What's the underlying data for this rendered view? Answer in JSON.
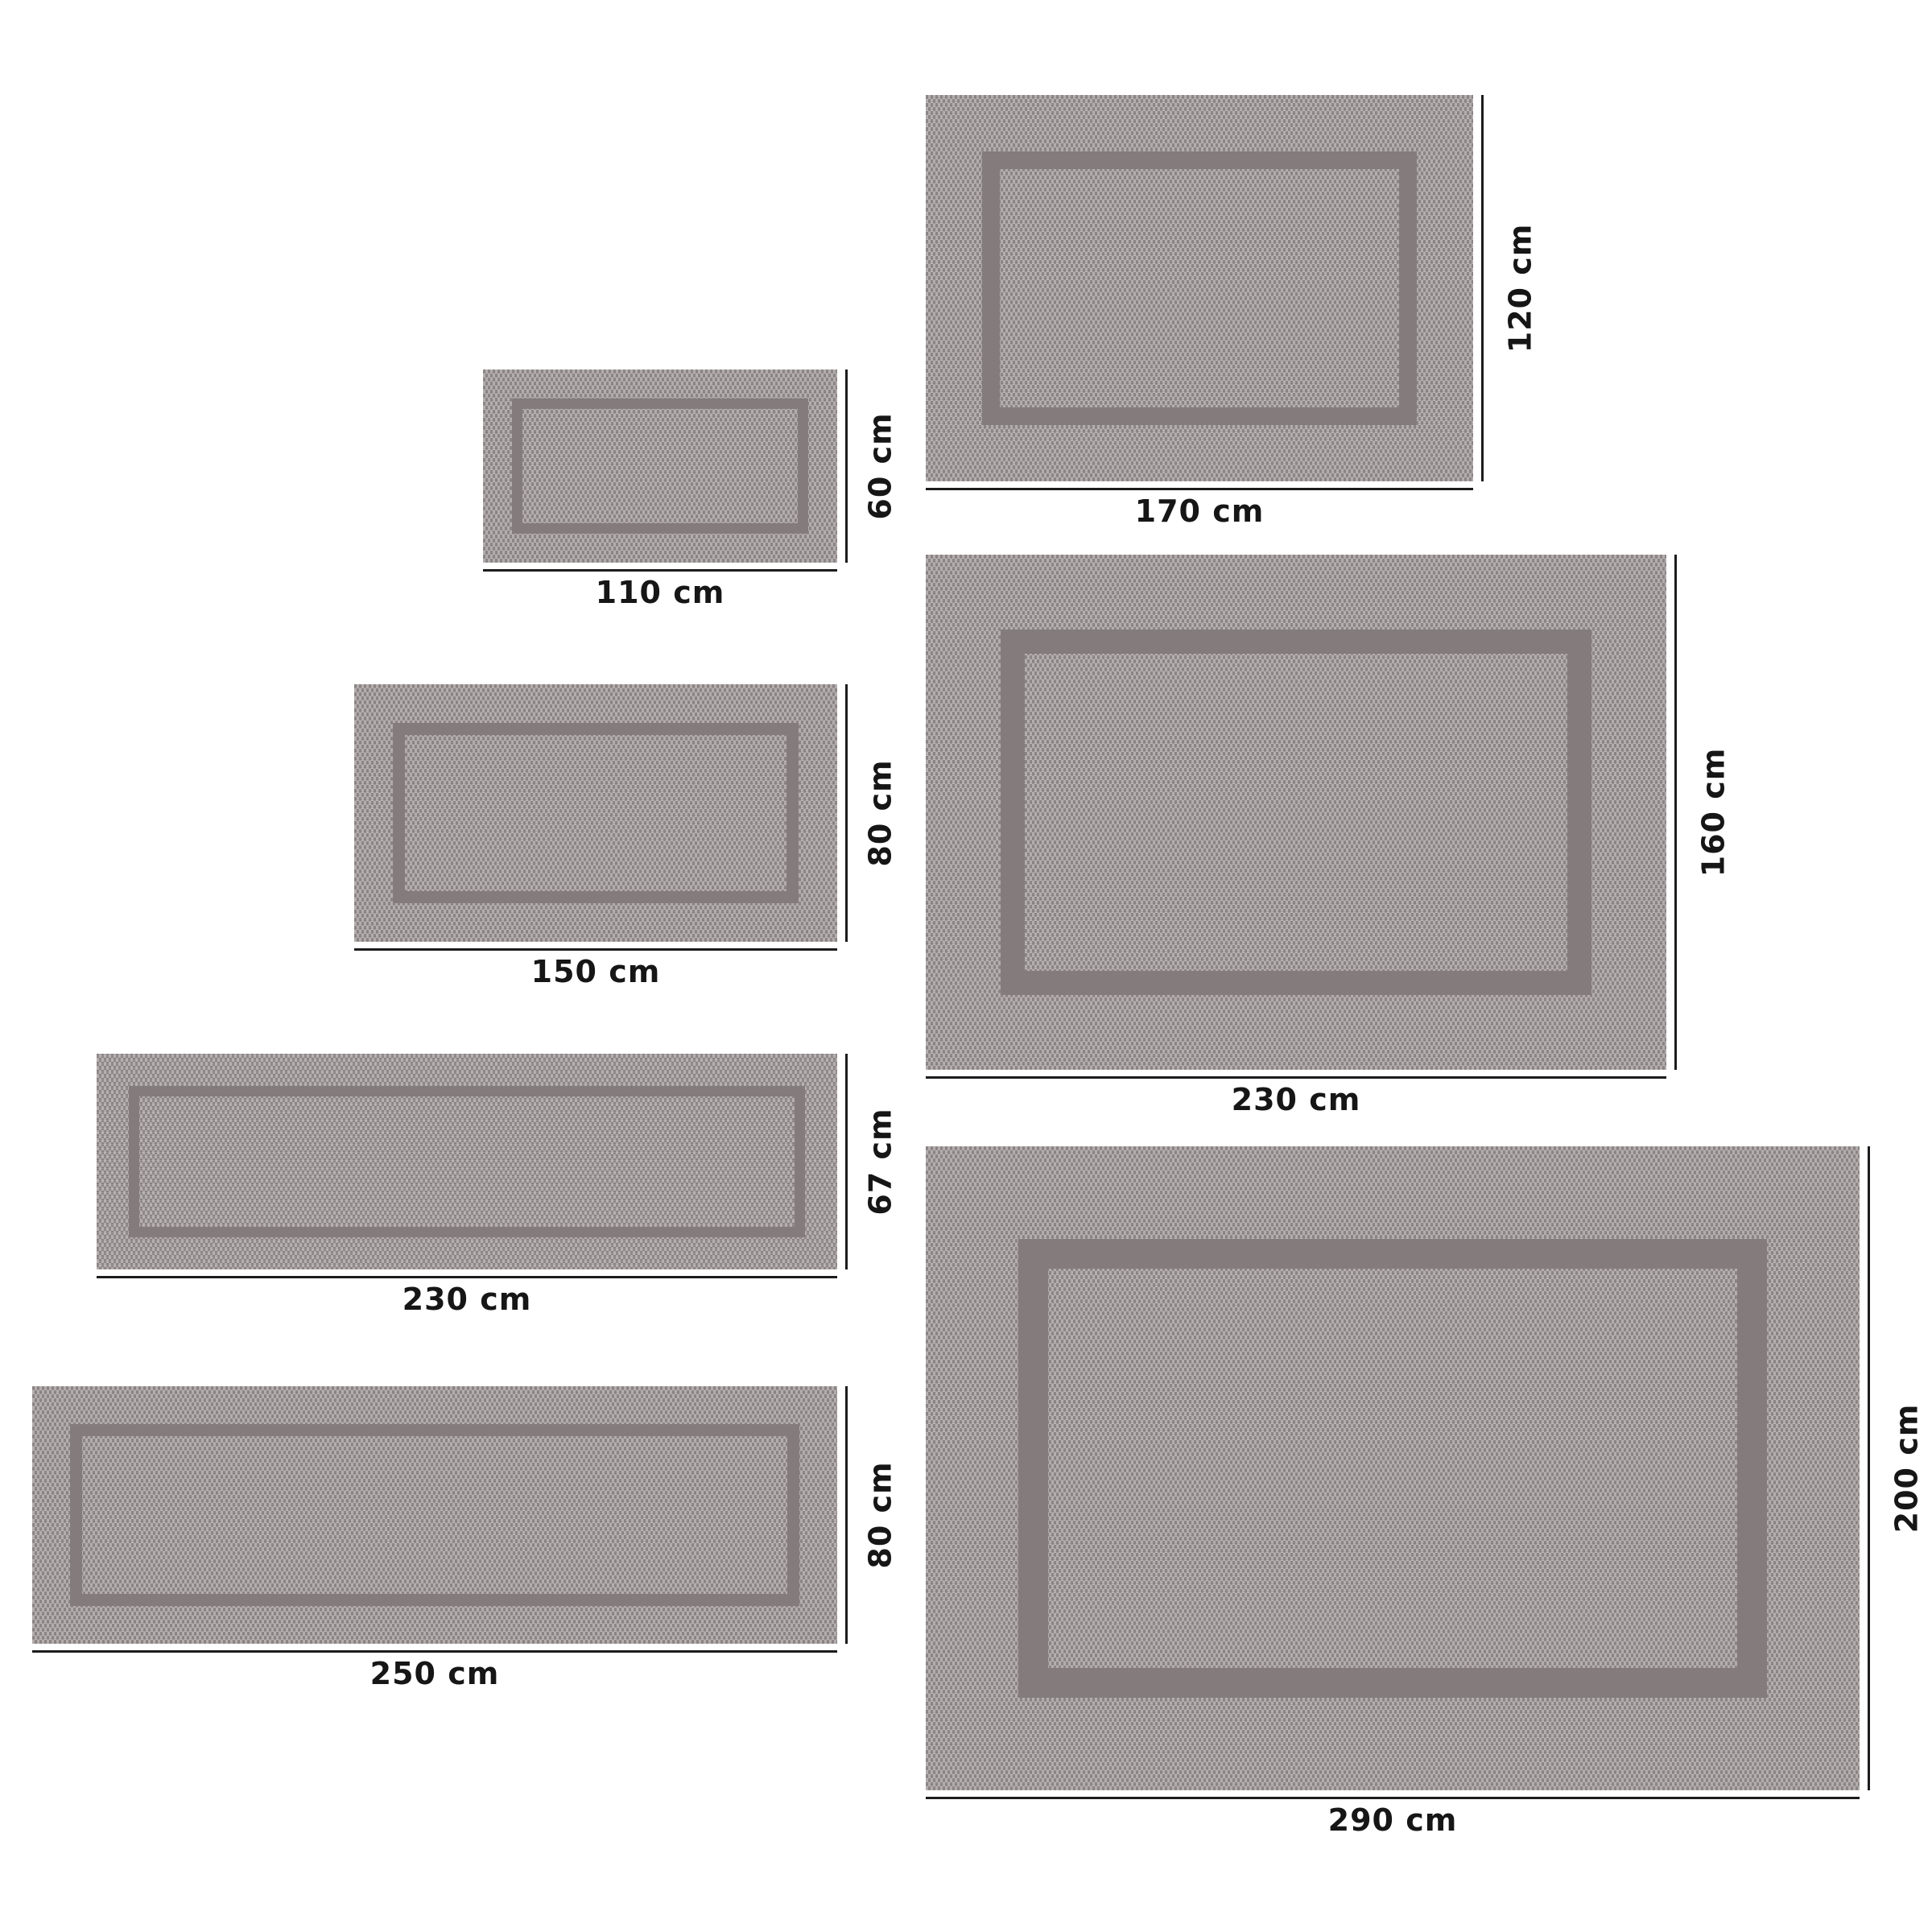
{
  "page": {
    "background": "#ffffff"
  },
  "colors": {
    "weave_light": "#b5aeae",
    "weave_dark": "#8d8686",
    "inner_border_band": "#847c7c",
    "dimension_line": "#1c1c1c",
    "label_text": "#161616"
  },
  "rugs": [
    {
      "id": "110x60",
      "width_cm": 110,
      "height_cm": 60,
      "width_label": "110 cm",
      "height_label": "60 cm"
    },
    {
      "id": "150x80",
      "width_cm": 150,
      "height_cm": 80,
      "width_label": "150 cm",
      "height_label": "80 cm"
    },
    {
      "id": "230x67",
      "width_cm": 230,
      "height_cm": 67,
      "width_label": "230 cm",
      "height_label": "67 cm"
    },
    {
      "id": "250x80",
      "width_cm": 250,
      "height_cm": 80,
      "width_label": "250 cm",
      "height_label": "80 cm"
    },
    {
      "id": "170x120",
      "width_cm": 170,
      "height_cm": 120,
      "width_label": "170 cm",
      "height_label": "120 cm"
    },
    {
      "id": "230x160",
      "width_cm": 230,
      "height_cm": 160,
      "width_label": "230 cm",
      "height_label": "160 cm"
    },
    {
      "id": "290x200",
      "width_cm": 290,
      "height_cm": 200,
      "width_label": "290 cm",
      "height_label": "200 cm"
    }
  ]
}
